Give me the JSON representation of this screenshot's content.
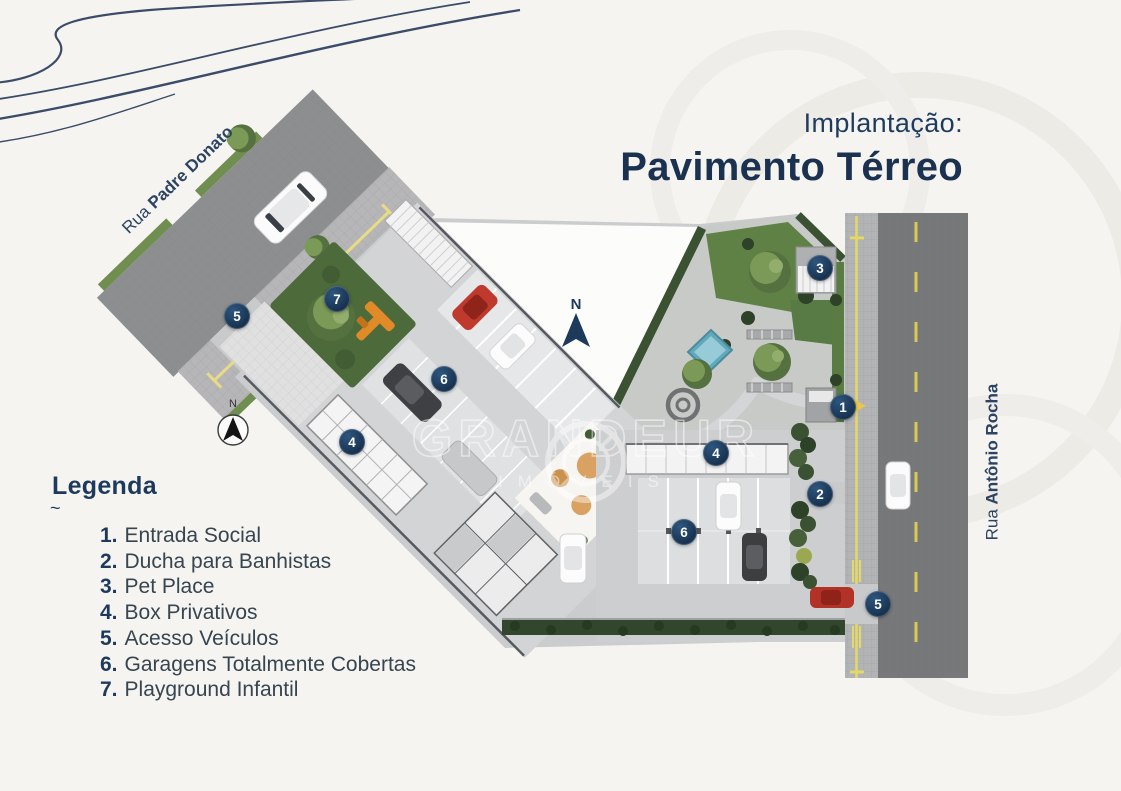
{
  "title": {
    "kicker": "Implantação:",
    "heading": "Pavimento Térreo"
  },
  "legend": {
    "heading": "Legenda",
    "tilde": "~",
    "items": [
      {
        "num": "1.",
        "label": "Entrada Social"
      },
      {
        "num": "2.",
        "label": "Ducha para Banhistas"
      },
      {
        "num": "3.",
        "label": "Pet Place"
      },
      {
        "num": "4.",
        "label": "Box Privativos"
      },
      {
        "num": "5.",
        "label": "Acesso Veículos"
      },
      {
        "num": "6.",
        "label": "Garagens Totalmente Cobertas"
      },
      {
        "num": "7.",
        "label": "Playground Infantil"
      }
    ]
  },
  "streets": {
    "left": {
      "prefix": "Rua",
      "name": "Padre Donato"
    },
    "right": {
      "prefix": "Rua",
      "name": "Antônio Rocha"
    }
  },
  "north_arrow": {
    "label": "N"
  },
  "compass": {
    "label": "N"
  },
  "watermark": {
    "brand": "GRANDEUR",
    "sub": "IMÓVEIS"
  },
  "markers": [
    {
      "n": "5",
      "x": 237,
      "y": 316
    },
    {
      "n": "7",
      "x": 337,
      "y": 299
    },
    {
      "n": "6",
      "x": 444,
      "y": 379
    },
    {
      "n": "4",
      "x": 352,
      "y": 442
    },
    {
      "n": "4",
      "x": 716,
      "y": 453
    },
    {
      "n": "6",
      "x": 684,
      "y": 532
    },
    {
      "n": "1",
      "x": 843,
      "y": 407
    },
    {
      "n": "2",
      "x": 820,
      "y": 494
    },
    {
      "n": "3",
      "x": 820,
      "y": 268
    },
    {
      "n": "5",
      "x": 878,
      "y": 604
    }
  ],
  "colors": {
    "navy": "#1d3a5c",
    "marker_fill": "#17314e",
    "road_left": "#8d8e90",
    "road_right": "#77787a",
    "sidewalk": "#b6b6b8",
    "lane_yellow": "#e4d967",
    "lawn_green": "#5f8146",
    "hedge_green": "#33492e",
    "pool_blue": "#62aabb",
    "playground_orange": "#e08a28",
    "background": "#f5f4f1"
  }
}
